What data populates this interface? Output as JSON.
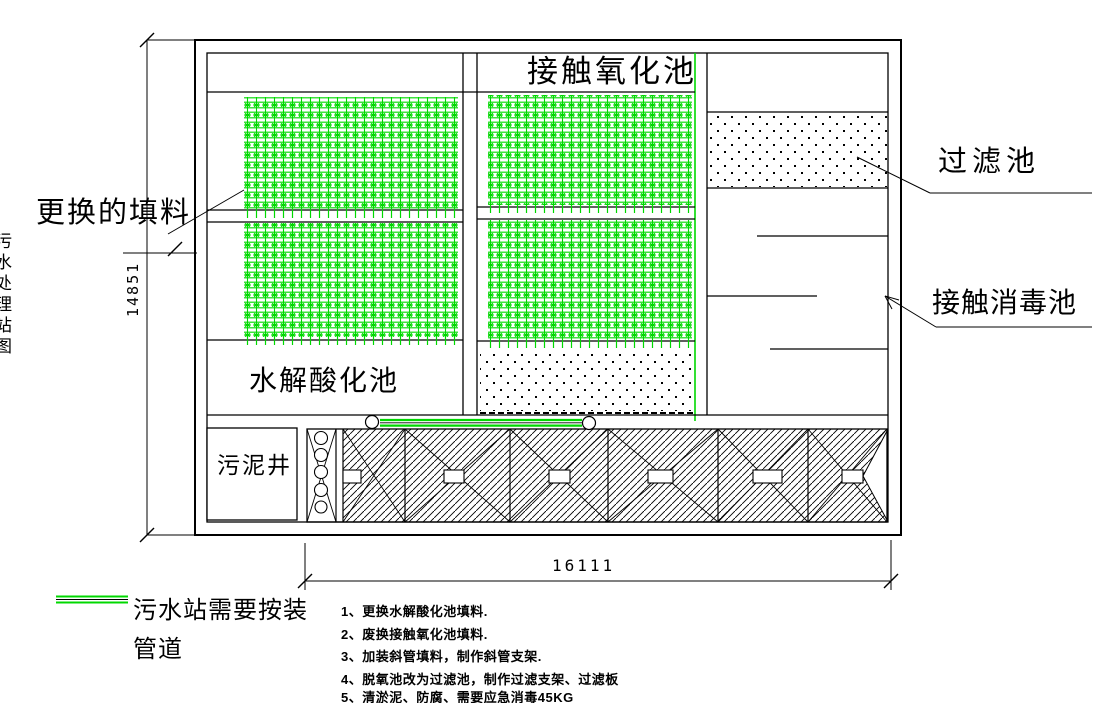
{
  "colors": {
    "media_green": "#00d800",
    "line_black": "#000000"
  },
  "labels": {
    "contact_oxidation_pool": "接触氧化池",
    "replaced_media": "更换的填料",
    "filter_pool": "过滤池",
    "contact_disinfection_pool": "接触消毒池",
    "hydrolysis_acidification_pool": "水解酸化池",
    "sludge_well": "污泥井"
  },
  "dimensions": {
    "height_mm": "14851",
    "width_mm": "16111"
  },
  "legend": {
    "line1": "污水站需要按装",
    "line2": "管道"
  },
  "notes": [
    "1、更换水解酸化池填料.",
    "2、废换接触氧化池填料.",
    "3、加装斜管填料，制作斜管支架.",
    "4、脱氧池改为过滤池，制作过滤支架、过滤板",
    "5、清淤泥、防腐、需要应急消毒45KG"
  ],
  "edge_text": "污水处理站图"
}
